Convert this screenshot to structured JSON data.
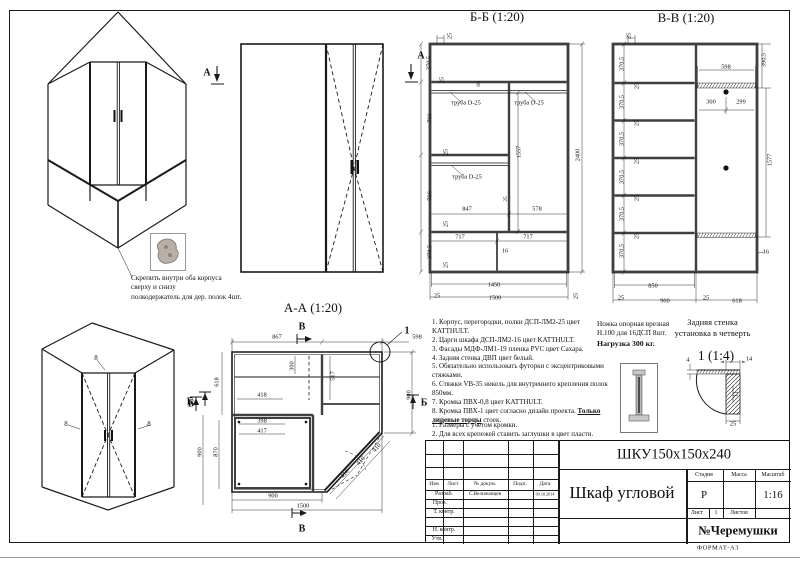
{
  "sheet": {
    "format": "ФОРМАТ-А3"
  },
  "views": {
    "bb_title": "Б-Б (1:20)",
    "vv_title": "В-В (1:20)",
    "aa_title": "А-А (1:20)",
    "detail_title": "1 (1:4)",
    "detail_ref": "1",
    "marker_a": "А",
    "marker_b": "Б",
    "marker_v": "В",
    "edge_mark": "8"
  },
  "annotations": {
    "fasten_l1": "Скрепить внутри оба корпуса",
    "fasten_l2": "сверху и снизу",
    "fasten_l3": "полкодержатель для дер. полок 4шт.",
    "tube": "труба D-25",
    "back_l1": "Задняя стенка",
    "back_l2": "установка в четверть",
    "leg_l1": "Ножка опорная врезная",
    "leg_l2": "Н.100 для 16ДСП 8шт.",
    "leg_l3": "Нагрузка 300 кг."
  },
  "notes": {
    "main": [
      "1. Корпус, перегородки, полки ДСП-ЛМ2-25 цвет KATTHULT.",
      "2. Царги шкафа ДСП-ЛМ2-16 цвет KATTHULT.",
      "3. Фасады МДФ-ЛМ1-19 пленка PVC цвет Сахара.",
      "4. Задняя стенка ДВП цвет белый.",
      "5. Обязательно использовать футорки с эксцентриковыми стяжками.",
      "6. Стяжки VB-35 никель для внутреннего крепления полок 850мм.",
      "7. Кромка ПВХ-0,8 цвет KATTHULT."
    ],
    "note8_start": "8. Кромка ПВХ-1 цвет согласно дизайн проекта. ",
    "note8_underline": "Только лицевые торцы",
    "note8_end": " стоек.",
    "extra": [
      "1. Размеры с учетом кромки.",
      "2. Для всех крепежей ставить заглушки в цвет пласти."
    ]
  },
  "dims": {
    "bb": {
      "top25": "25",
      "left": [
        "370.5",
        "25",
        "766",
        "25",
        "766",
        "25",
        "370.5",
        "25"
      ],
      "d60": "60",
      "w847": "847",
      "wp25": "25",
      "w578": "578",
      "h1557": "1557",
      "h2400": "2400",
      "w717a": "717",
      "w717b": "717",
      "t16": "16",
      "b1450": "1450",
      "b25l": "25",
      "b1500": "1500",
      "b25r": "25"
    },
    "vv": {
      "top25": "25",
      "sections": [
        "370.5",
        "370.5",
        "370.5",
        "370.5",
        "370.5",
        "370.5"
      ],
      "gaps": [
        "25",
        "25",
        "25",
        "25",
        "25"
      ],
      "w598": "598",
      "w300": "300",
      "w299": "299",
      "h390": "390.5",
      "h1577": "1577",
      "t16": "16",
      "b850": "850",
      "b25l": "25",
      "b900": "900",
      "b25m": "25",
      "b618": "618"
    },
    "aa": {
      "t867": "867",
      "t598": "598",
      "r900": "900",
      "l618": "618",
      "l900": "900",
      "l870": "870",
      "i418": "418",
      "i398": "398",
      "i417": "417",
      "i300": "300",
      "i517": "517",
      "d410a": "410",
      "d410b": "410",
      "d410c": "410",
      "b900": "900",
      "b1500": "1500"
    },
    "detail": {
      "d14": "14",
      "d4": "4",
      "d11": "11",
      "d25": "25"
    }
  },
  "titleblock": {
    "code": "ШКУ150х150х240",
    "name": "Шкаф угловой",
    "doc": "№Черемушки",
    "cols": {
      "izm": "Изм",
      "list": "Лист",
      "ndoc": "№ докум.",
      "podp": "Подп.",
      "data": "Дата"
    },
    "rows": {
      "razrab": "Разраб.",
      "prov": "Пров.",
      "tkontr": "Т. контр.",
      "nkontr": "Н. контр.",
      "utv": "Утв."
    },
    "developer": "С.Велижанцев",
    "date": "09.10.2014",
    "stage_label": "Стадия",
    "mass_label": "Масса",
    "scale_label": "Масштаб",
    "stage": "Р",
    "scale": "1:16",
    "sheet_label": "Лист",
    "sheet_no": "1",
    "sheets_label": "Листов"
  }
}
